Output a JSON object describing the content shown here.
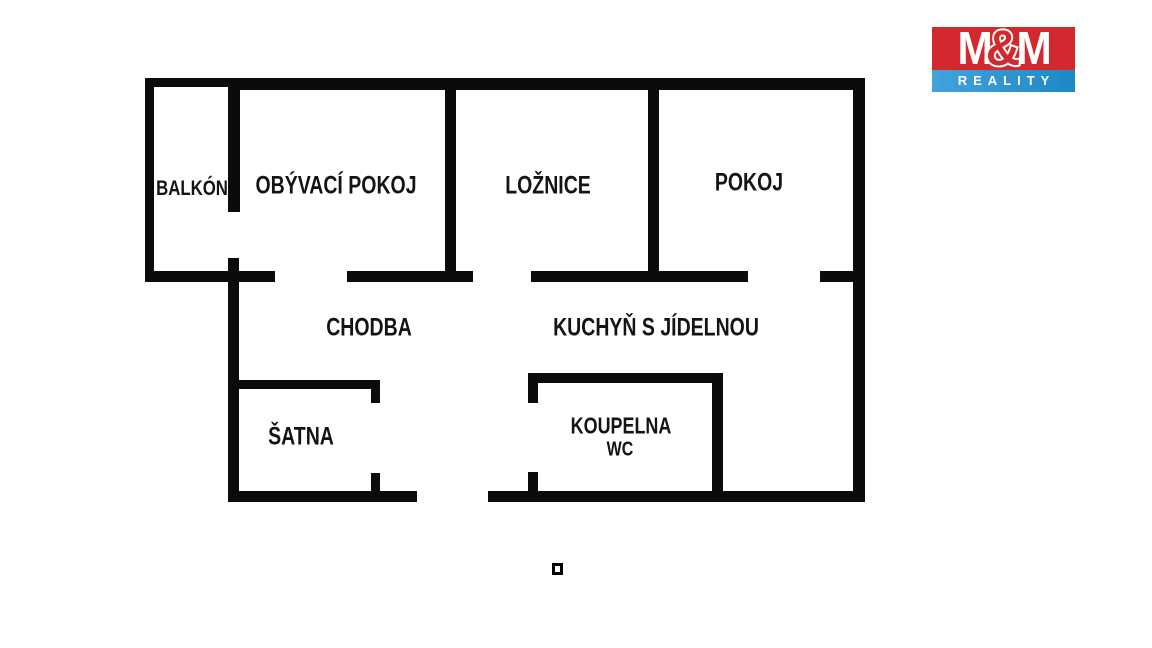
{
  "floorplan": {
    "rooms": [
      {
        "id": "balkon",
        "label": "BALKÓN"
      },
      {
        "id": "obyvaci",
        "label": "OBÝVACÍ POKOJ"
      },
      {
        "id": "loznice",
        "label": "LOŽNICE"
      },
      {
        "id": "pokoj",
        "label": "POKOJ"
      },
      {
        "id": "chodba",
        "label": "CHODBA"
      },
      {
        "id": "kuchyn",
        "label": "KUCHYŇ S JÍDELNOU"
      },
      {
        "id": "satna",
        "label": "ŠATNA"
      },
      {
        "id": "koupelna",
        "label": "KOUPELNA",
        "label2": "WC"
      }
    ],
    "wall_color": "#0b0b0b",
    "background_color": "#ffffff"
  },
  "logo": {
    "m_left": "M",
    "amp": "&",
    "m_right": "M",
    "reality": "REALITY",
    "red": "#d2292f",
    "blue": "#2f95d0"
  }
}
